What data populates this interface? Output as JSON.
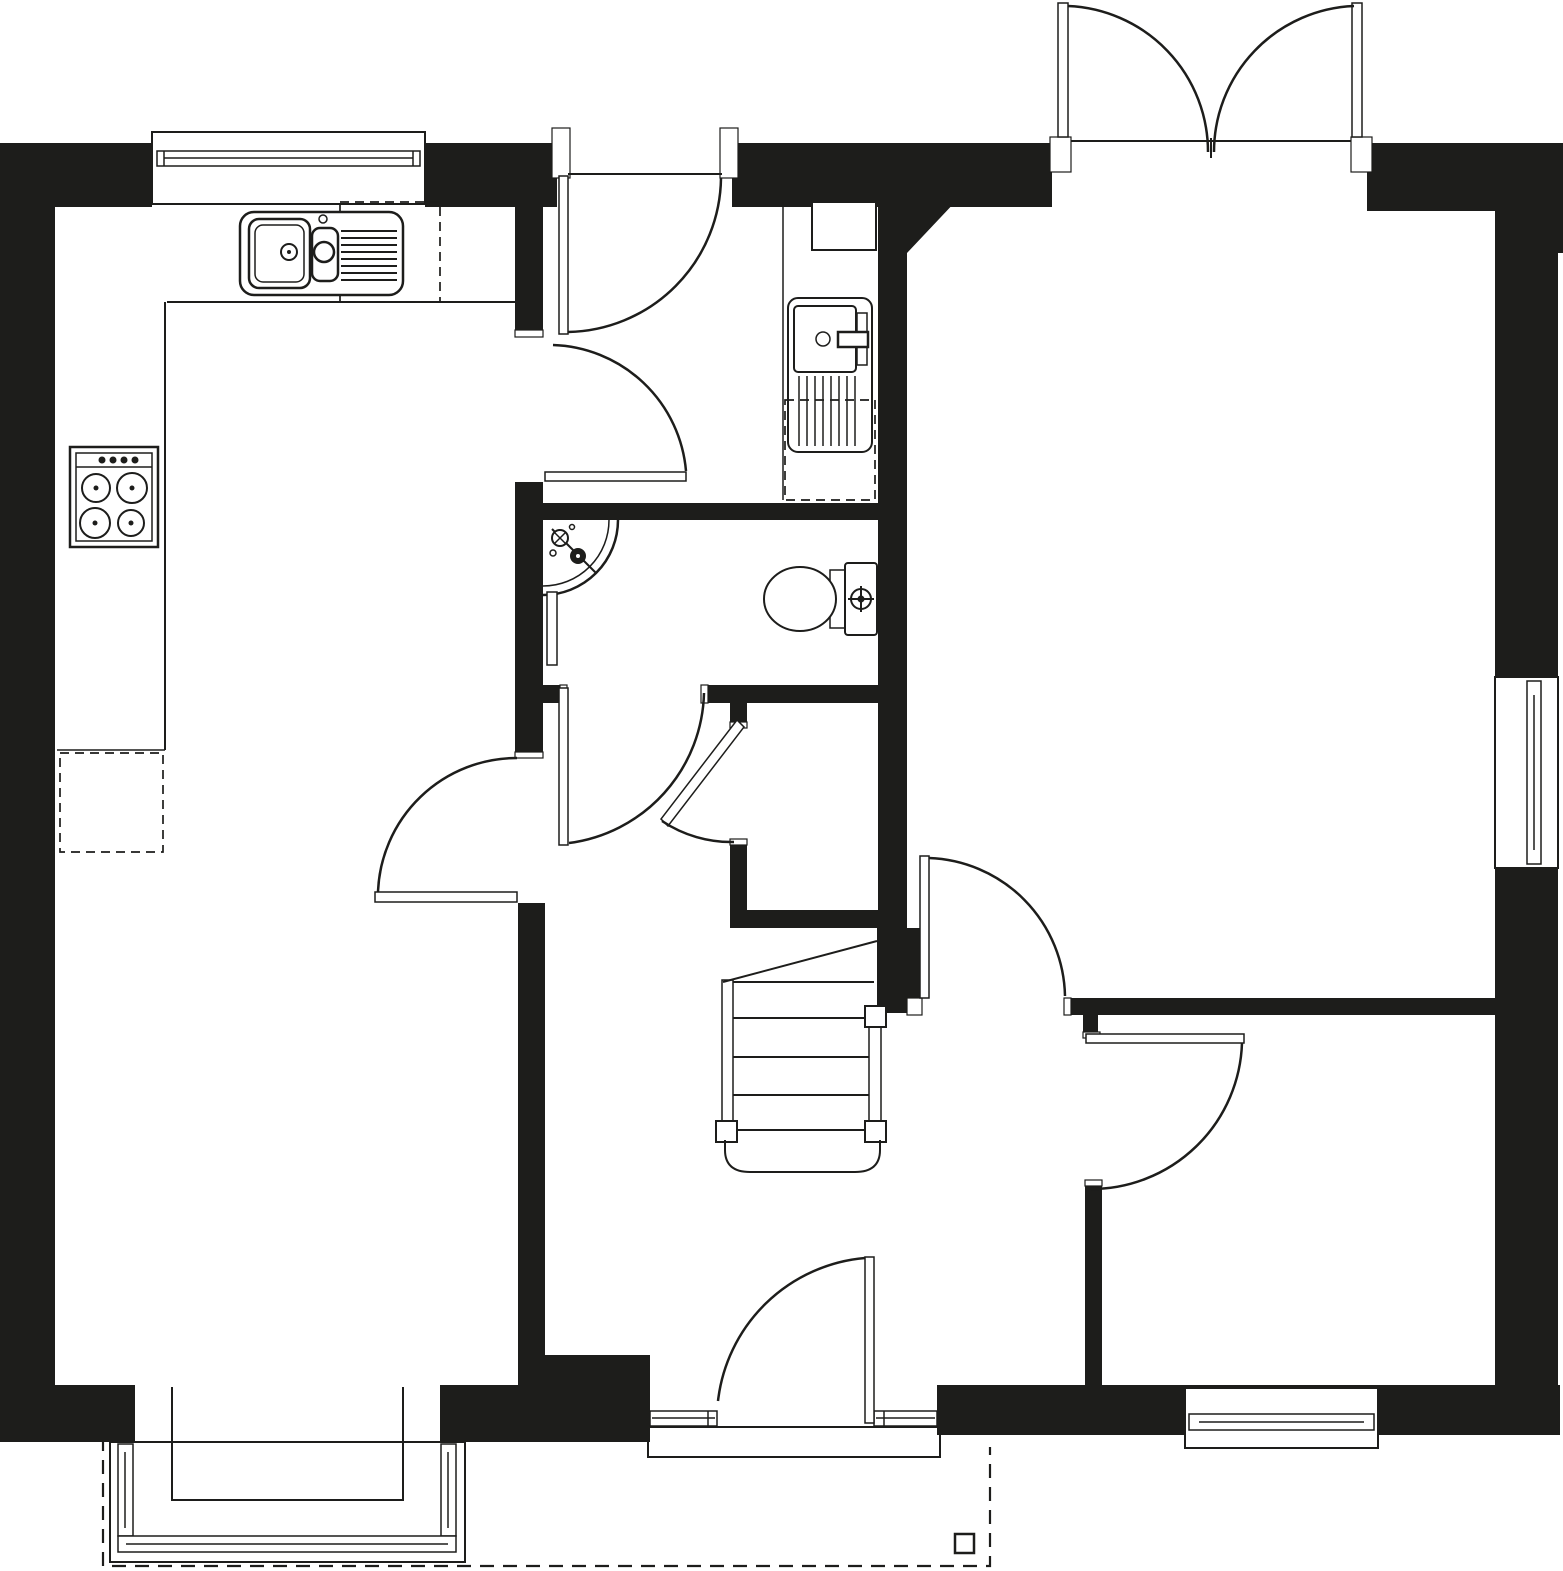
{
  "meta": {
    "name": "ground-floor-plan",
    "type": "architectural floor plan line drawing",
    "canvas_width": 1563,
    "canvas_height": 1571,
    "visible_text": "none"
  },
  "palette": {
    "ink": "#1d1d1b",
    "paper": "#ffffff"
  },
  "rooms": [
    {
      "id": "kitchen-diner",
      "position": "top-left",
      "features": [
        "sink-unit",
        "hob",
        "worktops",
        "appliance-space"
      ]
    },
    {
      "id": "lounge",
      "position": "bottom-left",
      "features": [
        "bay-window"
      ]
    },
    {
      "id": "entrance-hall",
      "position": "top-centre",
      "features": [
        "front-door",
        "utility-recess"
      ]
    },
    {
      "id": "inner-hall",
      "position": "centre",
      "features": [
        "staircase",
        "rear-door"
      ]
    },
    {
      "id": "cloakroom-wc",
      "position": "centre",
      "features": [
        "corner-basin",
        "toilet",
        "radiator"
      ]
    },
    {
      "id": "under-stairs-cupboard",
      "position": "centre",
      "features": [
        "cupboard-door"
      ]
    },
    {
      "id": "living-room",
      "position": "top-right",
      "features": [
        "french-doors",
        "side-window",
        "chamfered-corner"
      ]
    },
    {
      "id": "study",
      "position": "bottom-right",
      "features": [
        "rear-window"
      ]
    }
  ],
  "doors": [
    {
      "id": "front-entrance-door",
      "wall": "north",
      "swing": "inward-left-hinge"
    },
    {
      "id": "french-doors",
      "wall": "north",
      "swing": "double-outward"
    },
    {
      "id": "kitchen-north-door",
      "wall": "kitchen-hall",
      "swing": "into-vestibule"
    },
    {
      "id": "kitchen-south-door",
      "wall": "kitchen-hall",
      "swing": "into-kitchen"
    },
    {
      "id": "wc-door",
      "wall": "wc-south",
      "swing": "outward"
    },
    {
      "id": "cupboard-door",
      "wall": "cupboard-west",
      "swing": "half-open"
    },
    {
      "id": "living-room-door",
      "wall": "living-south",
      "swing": "into-living-room"
    },
    {
      "id": "study-door",
      "wall": "study-north",
      "swing": "into-study"
    },
    {
      "id": "rear-garden-door",
      "wall": "south",
      "swing": "inward",
      "sidelights": 2
    }
  ],
  "windows": [
    {
      "id": "kitchen-window",
      "wall": "north"
    },
    {
      "id": "bay-window",
      "wall": "south",
      "room": "lounge",
      "shape": "square-bay"
    },
    {
      "id": "side-window",
      "wall": "east",
      "room": "living-room"
    },
    {
      "id": "study-window",
      "wall": "south",
      "room": "study"
    }
  ],
  "fixtures": [
    {
      "id": "kitchen-sink",
      "detail": "one-and-half-bowl-with-drainer"
    },
    {
      "id": "hob",
      "detail": "four-burner"
    },
    {
      "id": "washing-machine",
      "detail": "under-counter-dashed-space"
    },
    {
      "id": "boiler-cupboard",
      "detail": "wall-mounted"
    },
    {
      "id": "corner-basin",
      "detail": "quarter-circle-with-tap"
    },
    {
      "id": "toilet",
      "detail": "cistern-and-bowl"
    },
    {
      "id": "radiator",
      "detail": "wc-wall"
    },
    {
      "id": "staircase",
      "detail": "straight-flight-up",
      "treads_visible": 6
    }
  ],
  "outside": [
    {
      "id": "patio-outline",
      "style": "dashed"
    },
    {
      "id": "porch-step",
      "style": "solid-outline"
    },
    {
      "id": "patio-post",
      "style": "small-square"
    }
  ]
}
